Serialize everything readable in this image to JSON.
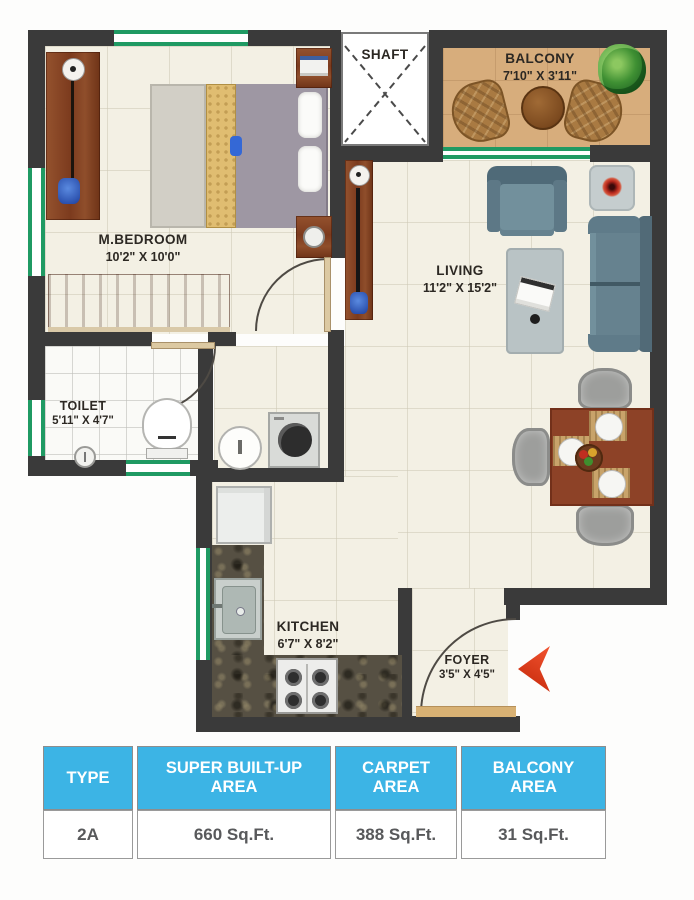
{
  "plan": {
    "shaft": {
      "label": "SHAFT"
    },
    "balcony": {
      "label": "BALCONY",
      "dims": "7'10\" X 3'11\""
    },
    "bedroom": {
      "label": "M.BEDROOM",
      "dims": "10'2\" X 10'0\""
    },
    "living": {
      "label": "LIVING",
      "dims": "11'2\" X 15'2\""
    },
    "toilet": {
      "label": "TOILET",
      "dims": "5'11\" X 4'7\""
    },
    "kitchen": {
      "label": "KITCHEN",
      "dims": "6'7\" X 8'2\""
    },
    "foyer": {
      "label": "FOYER",
      "dims": "3'5\" X 4'5\""
    },
    "colors": {
      "wall": "#3a3a3a",
      "window_green": "#1f9a63",
      "balcony_floor": "#d7ad7c",
      "entry_arrow_red": "#e23a1c",
      "header_blue": "#3cb4e5"
    }
  },
  "spec_table": {
    "headers": [
      "TYPE",
      "SUPER BUILT-UP AREA",
      "CARPET AREA",
      "BALCONY AREA"
    ],
    "row": [
      "2A",
      "660 Sq.Ft.",
      "388 Sq.Ft.",
      "31 Sq.Ft."
    ]
  }
}
